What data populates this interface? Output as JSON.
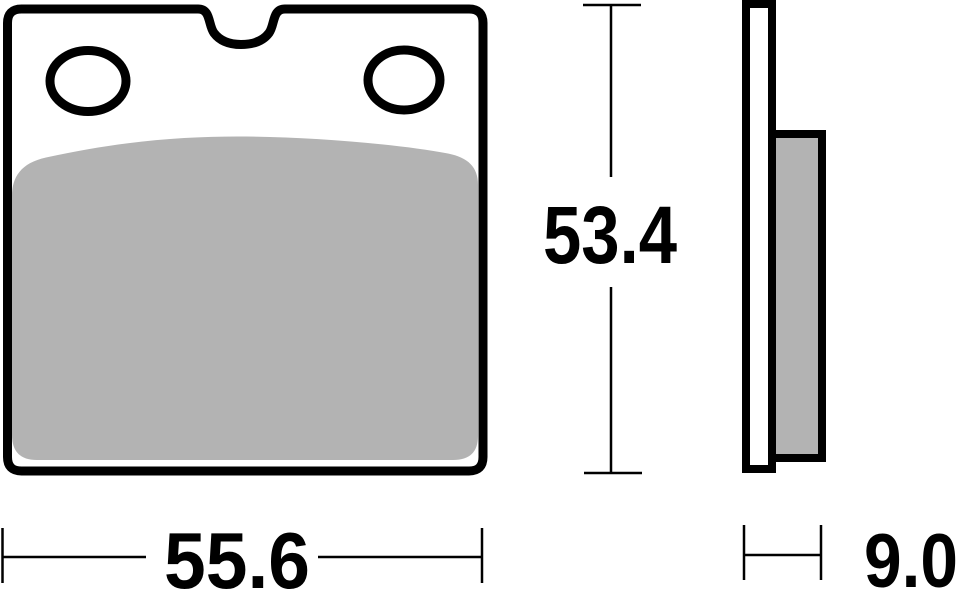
{
  "drawing": {
    "dimensions": {
      "height": "53.4",
      "width": "55.6",
      "thickness": "9.0"
    },
    "colors": {
      "line": "#000000",
      "friction": "#b3b3b3",
      "plate_fill": "#ffffff"
    }
  }
}
